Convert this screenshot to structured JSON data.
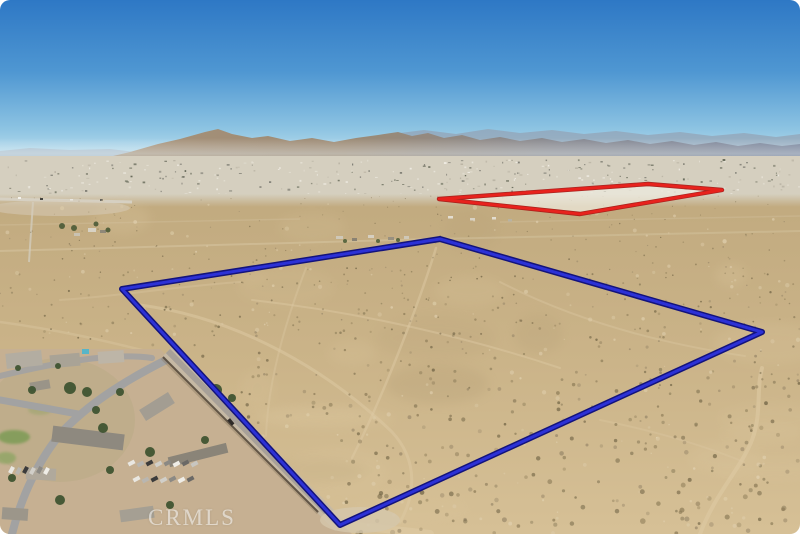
{
  "watermark": {
    "text": "CRMLS"
  },
  "overlays": {
    "blue_parcel": {
      "points": "122,289 440,239 762,332 340,525",
      "edge_color": "#13137c",
      "core_color": "#2c31d6",
      "edge_width": "6",
      "core_width": "3"
    },
    "red_parcel": {
      "points": "439,199 648,184 722,190 580,214",
      "edge_color": "#a81310",
      "stroke": "#e8221d",
      "fill": "#f0ede2",
      "fill_opacity": "0.78",
      "edge_width": "4.4",
      "stroke_width": "2.8"
    }
  },
  "palette": {
    "sky_top": "#2e78c5",
    "sky_mid": "#4f97d2",
    "sky_low": "#8cc3e2",
    "sky_horizon": "#bfe0ee",
    "mtn_left": "#a8937a",
    "mtn_midleft": "#9c8a74",
    "mtn_midright": "#87888f",
    "mtn_right": "#76829a",
    "mtn_far": "#93a2b4",
    "mtn_farleft": "#a4adbb",
    "valley_band": "#d5cfbf",
    "desert_top": "#c1aa7f",
    "desert_mid": "#cbb489",
    "desert_bottom": "#d6c096",
    "neighborhood_base": "#c6b092",
    "road_shoulder": "#c6b9a4",
    "road_center": "#a7a098",
    "wall": "#54483a",
    "trail": "#ddc9a3"
  },
  "texture": {
    "seed": 1377,
    "scrub": {
      "count": 850,
      "light_count": 210,
      "dark_colors": [
        "#8d7c58",
        "#7a6c4c",
        "#6d6143",
        "#99886a"
      ],
      "light_colors": [
        "#e4d5b5",
        "#decdab"
      ]
    },
    "city_specks": {
      "count": 320,
      "colors": [
        "#f1eee6",
        "#6e6e66",
        "#b8b2a2",
        "#5c6050",
        "#e8e4d8"
      ]
    },
    "patches": {
      "count": 30,
      "colors": [
        "#dcc79f",
        "#b29c74"
      ]
    }
  },
  "neighborhood": {
    "houses": [
      {
        "x": 6,
        "y": 352,
        "w": 36,
        "h": 15,
        "fill": "#b3ada1",
        "rot": -6
      },
      {
        "x": 50,
        "y": 354,
        "w": 30,
        "h": 13,
        "fill": "#a9a396",
        "rot": -5
      },
      {
        "x": 98,
        "y": 351,
        "w": 26,
        "h": 12,
        "fill": "#bdb5a7",
        "rot": -4
      },
      {
        "x": 82,
        "y": 349,
        "w": 7,
        "h": 5,
        "fill": "#58b5c8",
        "rot": 0
      },
      {
        "x": 30,
        "y": 381,
        "w": 20,
        "h": 9,
        "fill": "#9a9488",
        "rot": -10
      },
      {
        "x": 52,
        "y": 430,
        "w": 72,
        "h": 16,
        "fill": "#8e897f",
        "rot": 7
      },
      {
        "x": 140,
        "y": 400,
        "w": 34,
        "h": 13,
        "fill": "#a39d92",
        "rot": -32
      },
      {
        "x": 26,
        "y": 468,
        "w": 30,
        "h": 12,
        "fill": "#b0a99c",
        "rot": 3
      },
      {
        "x": 168,
        "y": 450,
        "w": 60,
        "h": 10,
        "fill": "#8a8478",
        "rot": -14
      },
      {
        "x": 120,
        "y": 508,
        "w": 34,
        "h": 12,
        "fill": "#a59f93",
        "rot": -8
      },
      {
        "x": 2,
        "y": 508,
        "w": 26,
        "h": 12,
        "fill": "#9c968a",
        "rot": 4
      }
    ],
    "trees": [
      {
        "x": 70,
        "y": 388,
        "r": 6
      },
      {
        "x": 87,
        "y": 392,
        "r": 5
      },
      {
        "x": 103,
        "y": 428,
        "r": 5
      },
      {
        "x": 32,
        "y": 390,
        "r": 4
      },
      {
        "x": 120,
        "y": 392,
        "r": 4
      },
      {
        "x": 216,
        "y": 390,
        "r": 6
      },
      {
        "x": 232,
        "y": 398,
        "r": 4
      },
      {
        "x": 150,
        "y": 452,
        "r": 5
      },
      {
        "x": 110,
        "y": 470,
        "r": 4
      },
      {
        "x": 12,
        "y": 478,
        "r": 4
      },
      {
        "x": 60,
        "y": 500,
        "r": 5
      },
      {
        "x": 170,
        "y": 505,
        "r": 4
      },
      {
        "x": 205,
        "y": 440,
        "r": 4
      },
      {
        "x": 58,
        "y": 366,
        "r": 3
      },
      {
        "x": 18,
        "y": 368,
        "r": 3
      },
      {
        "x": 96,
        "y": 410,
        "r": 4
      }
    ],
    "lawns": [
      {
        "x": 14,
        "y": 437,
        "rx": 16,
        "ry": 7,
        "fill": "#7d9b55",
        "op": 0.85
      },
      {
        "x": 6,
        "y": 458,
        "rx": 10,
        "ry": 6,
        "fill": "#88a45e",
        "op": 0.7
      },
      {
        "x": 40,
        "y": 410,
        "rx": 12,
        "ry": 5,
        "fill": "#97a46b",
        "op": 0.5
      }
    ],
    "car_lot": {
      "rows": [
        {
          "x": 128,
          "y": 461,
          "count": 8,
          "step": 9,
          "rot": -28
        },
        {
          "x": 133,
          "y": 477,
          "count": 7,
          "step": 9,
          "rot": -28
        },
        {
          "x": 8,
          "y": 468,
          "count": 6,
          "step": 7,
          "rot": -62
        }
      ],
      "colors": [
        "#e9e7e1",
        "#b9b6b0",
        "#3b3b3b",
        "#d1cfc9",
        "#8b8984",
        "#efede7",
        "#6b6966",
        "#c8c6c0"
      ]
    }
  },
  "outbuildings": {
    "farm_left": [
      {
        "x": 88,
        "y": 228,
        "w": 8,
        "h": 4,
        "fill": "#d8d2c4"
      },
      {
        "x": 100,
        "y": 230,
        "w": 6,
        "h": 3,
        "fill": "#8f8878"
      },
      {
        "x": 74,
        "y": 233,
        "w": 6,
        "h": 3,
        "fill": "#c9c2b2"
      }
    ],
    "farm_left_trees": [
      {
        "x": 62,
        "y": 226,
        "r": 3
      },
      {
        "x": 74,
        "y": 228,
        "r": 3
      },
      {
        "x": 96,
        "y": 224,
        "r": 2.5
      },
      {
        "x": 108,
        "y": 230,
        "r": 2.5
      }
    ],
    "mid_cluster": [
      {
        "x": 336,
        "y": 236,
        "w": 7,
        "h": 3,
        "fill": "#cfc8b8"
      },
      {
        "x": 352,
        "y": 238,
        "w": 5,
        "h": 3,
        "fill": "#8a8272"
      },
      {
        "x": 368,
        "y": 235,
        "w": 6,
        "h": 3,
        "fill": "#d6cfc0"
      },
      {
        "x": 388,
        "y": 237,
        "w": 6,
        "h": 3,
        "fill": "#989080"
      },
      {
        "x": 404,
        "y": 236,
        "w": 5,
        "h": 3,
        "fill": "#cfc8b8"
      }
    ],
    "mid_cluster_trees": [
      {
        "x": 345,
        "y": 241,
        "r": 2
      },
      {
        "x": 378,
        "y": 241,
        "r": 2
      },
      {
        "x": 398,
        "y": 240,
        "r": 2
      }
    ],
    "below_red": [
      {
        "x": 448,
        "y": 216,
        "w": 5,
        "h": 2.5,
        "fill": "#e3ddd0"
      },
      {
        "x": 470,
        "y": 218,
        "w": 5,
        "h": 2.5,
        "fill": "#d8d2c4"
      },
      {
        "x": 492,
        "y": 217,
        "w": 4,
        "h": 2.5,
        "fill": "#e3ddd0"
      },
      {
        "x": 508,
        "y": 219,
        "w": 4,
        "h": 2.5,
        "fill": "#b8b2a2"
      }
    ],
    "left_road_vehicles": [
      {
        "x": 18,
        "y": 197,
        "w": 3,
        "h": 2,
        "fill": "#f4f2ec"
      },
      {
        "x": 40,
        "y": 198,
        "w": 3,
        "h": 2,
        "fill": "#45443f"
      },
      {
        "x": 70,
        "y": 199,
        "w": 3,
        "h": 2,
        "fill": "#e8e6e0"
      },
      {
        "x": 100,
        "y": 199,
        "w": 3,
        "h": 2,
        "fill": "#66645e"
      }
    ]
  }
}
